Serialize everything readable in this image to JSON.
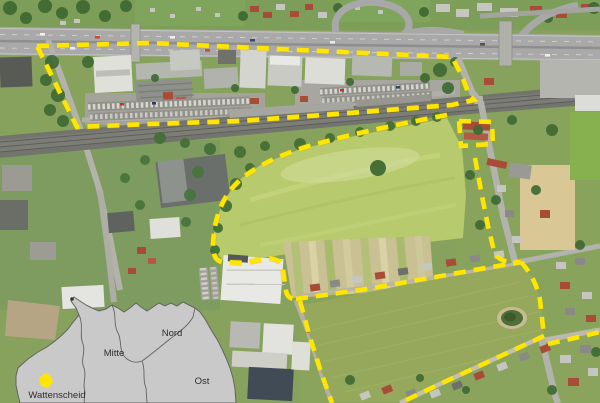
{
  "inset_map": {
    "districts": [
      {
        "label": "Nord"
      },
      {
        "label": "Mitte"
      },
      {
        "label": "Ost"
      },
      {
        "label": "Wattenscheid"
      }
    ],
    "map_fill": "#c9c9c9",
    "border_color": "#636363",
    "marker_color": "#ffe600"
  },
  "boundary": {
    "color": "#ffe600",
    "style": "dashed"
  },
  "aerial_colors": {
    "field_light_green": "#b7ca6d",
    "field_olive": "#95a85c",
    "field_tan": "#d9c795",
    "highway_gray": "#a9a9a9",
    "railway_gray": "#74746e"
  }
}
